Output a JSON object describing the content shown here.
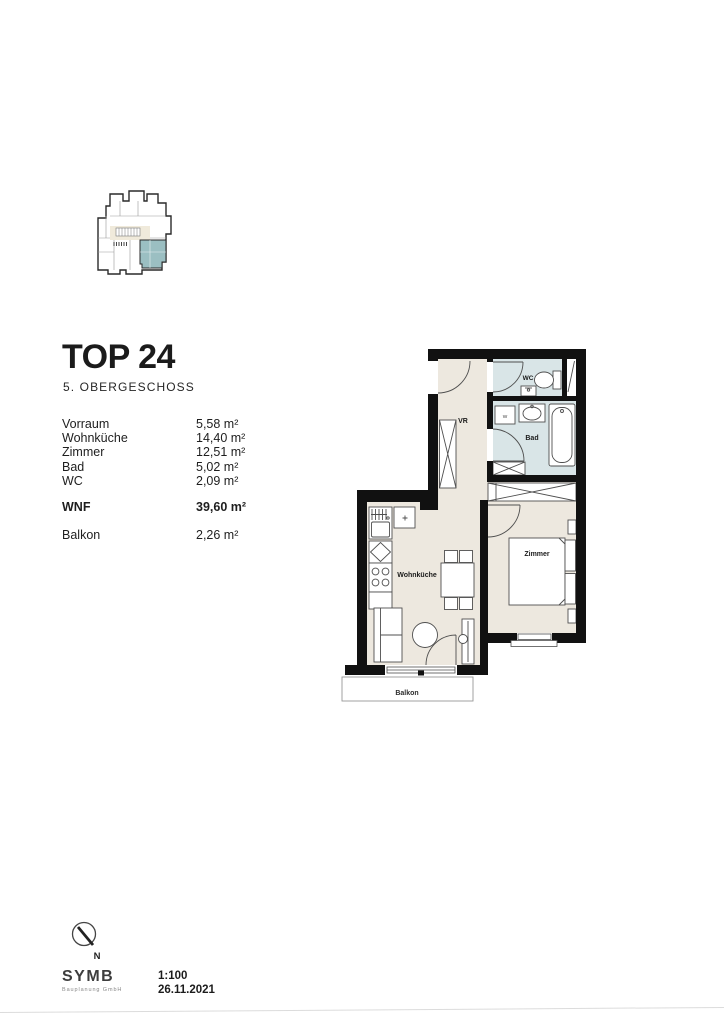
{
  "page": {
    "title": "TOP 24",
    "subtitle": "5. OBERGESCHOSS",
    "scale": "1:100",
    "date": "26.11.2021",
    "north_label": "N",
    "logo_name": "SYMB",
    "logo_tagline": "Bauplanung GmbH"
  },
  "area_table": {
    "rows": [
      {
        "label": "Vorraum",
        "value": "5,58 m²"
      },
      {
        "label": "Wohnküche",
        "value": "14,40 m²"
      },
      {
        "label": "Zimmer",
        "value": "12,51 m²"
      },
      {
        "label": "Bad",
        "value": "5,02 m²"
      },
      {
        "label": "WC",
        "value": "2,09 m²"
      }
    ],
    "total": {
      "label": "WNF",
      "value": "39,60 m²"
    },
    "extra": {
      "label": "Balkon",
      "value": "2,26 m²"
    }
  },
  "floorplan": {
    "labels": {
      "vr": "VR",
      "wc": "WC",
      "bad": "Bad",
      "zimmer": "Zimmer",
      "wohnkueche": "Wohnküche",
      "balkon": "Balkon",
      "washer": "W"
    },
    "colors": {
      "wall": "#111111",
      "floor": "#EDE8DF",
      "wet_floor": "#D9E5E7",
      "keyplan_highlight": "#9BBFC2",
      "keyplan_floor": "#F0EADB",
      "furniture_line": "#4f4f4f"
    }
  }
}
